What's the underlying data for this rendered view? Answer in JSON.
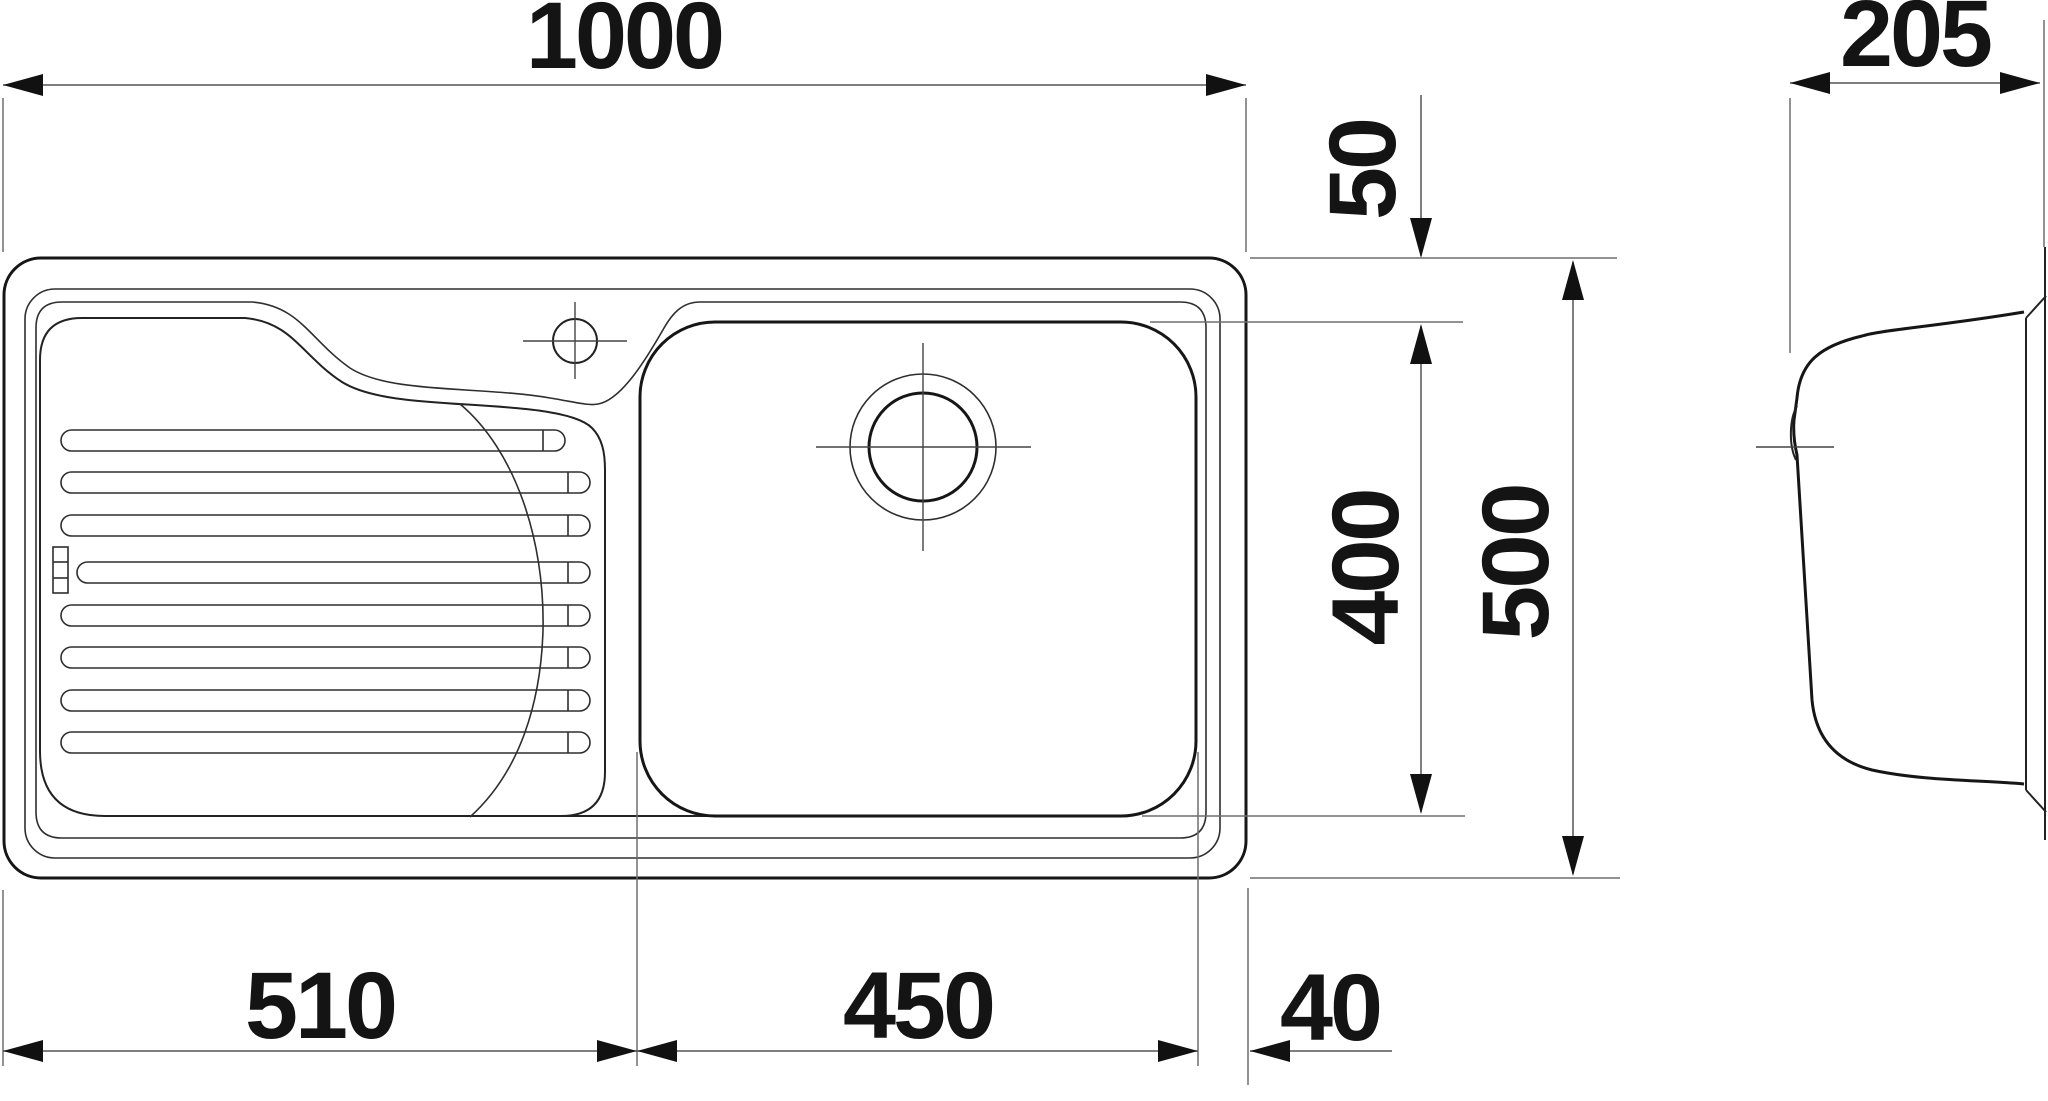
{
  "drawing": {
    "type": "technical-dimension-drawing",
    "subject": "kitchen sink with drainboard, top view and side view",
    "views": [
      "top-view",
      "side-view"
    ],
    "units_shown": false
  },
  "dimensions": {
    "overall_width": "1000",
    "side_depth": "205",
    "rim_to_bowl": "50",
    "bowl_length": "400",
    "overall_depth": "500",
    "drainer_width": "510",
    "bowl_width": "450",
    "edge_offset": "40"
  }
}
